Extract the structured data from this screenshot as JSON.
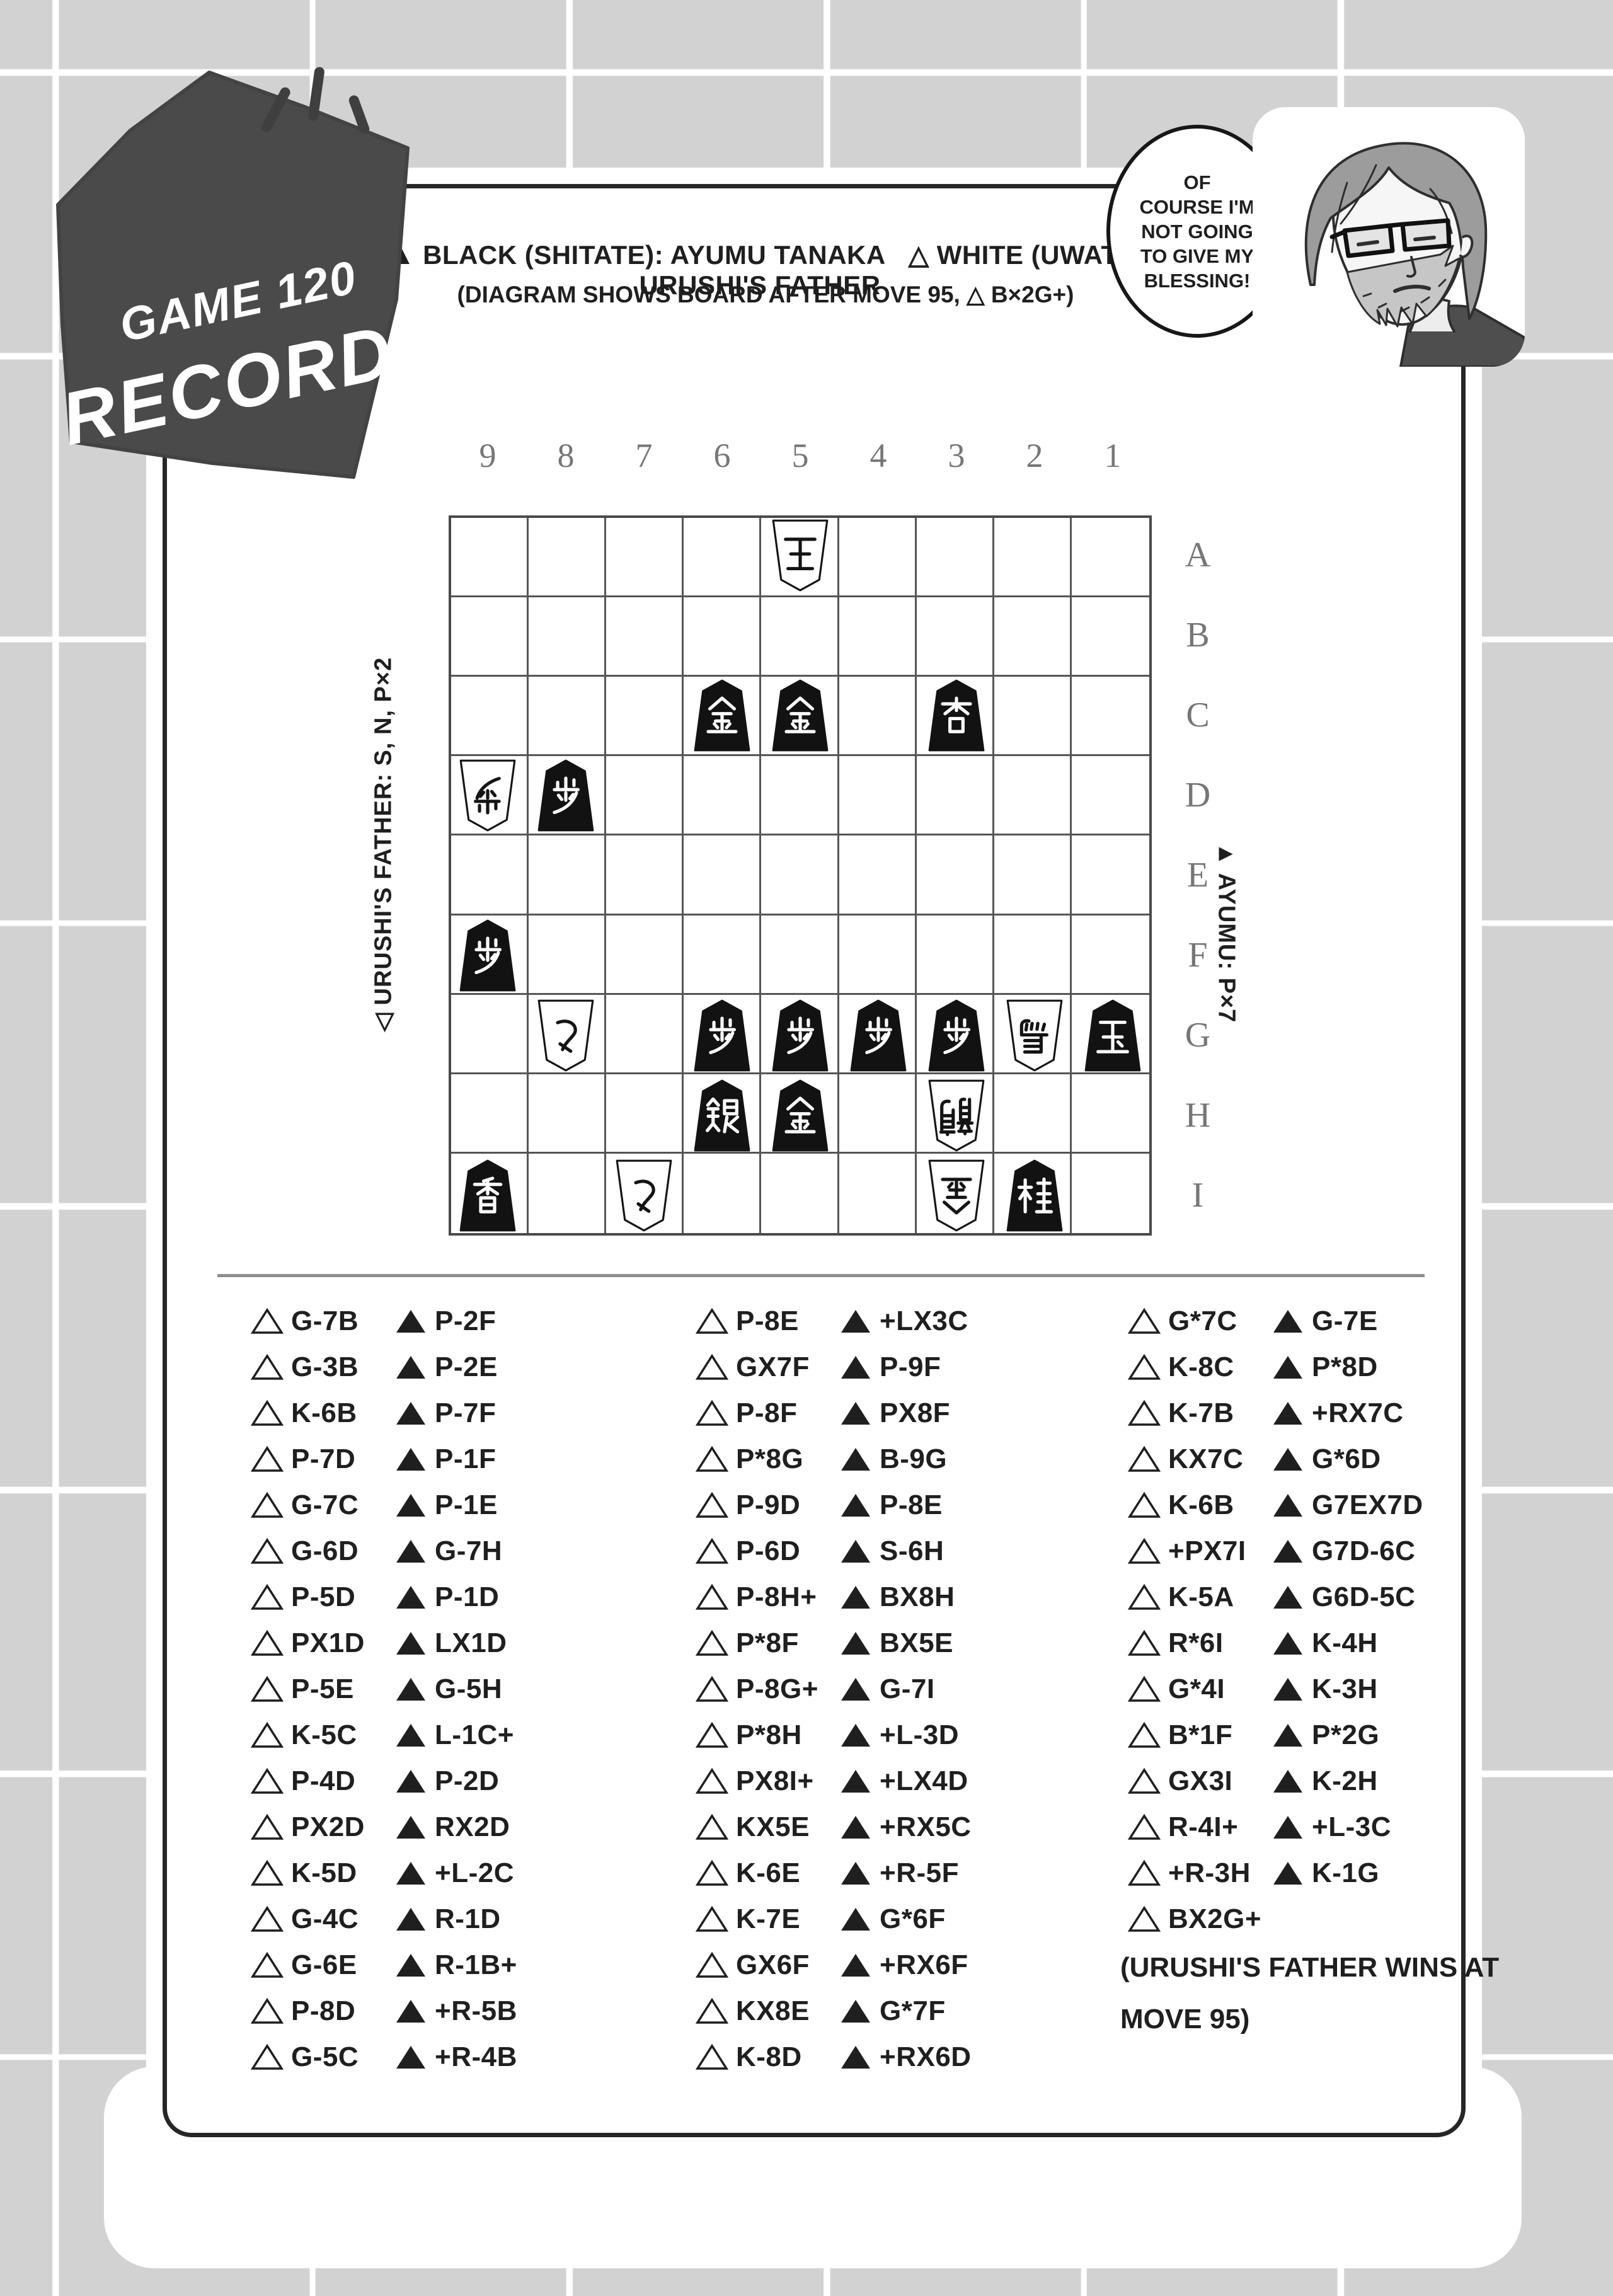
{
  "colors": {
    "page_bg": "#d2d2d2",
    "grid_line": "#ffffff",
    "panel_bg": "#ffffff",
    "panel_border": "#262626",
    "badge_bg": "#4a4a4a",
    "text": "#1f1f1f",
    "board_line": "#4f4f4f",
    "label_gray": "#767676"
  },
  "badge": {
    "line1": "GAME 120",
    "line2": "RECORD"
  },
  "header": {
    "black_side": "▲ BLACK (SHITATE): AYUMU TANAKA",
    "white_side": "△ WHITE (UWATE): URUSHI'S FATHER",
    "note": "(DIAGRAM SHOWS BOARD AFTER MOVE 95, △ B×2G+)"
  },
  "speech_bubble": {
    "lines": [
      "OF",
      "COURSE I'M",
      "NOT GOING",
      "TO GIVE MY",
      "BLESSING!"
    ]
  },
  "board": {
    "columns": [
      "9",
      "8",
      "7",
      "6",
      "5",
      "4",
      "3",
      "2",
      "1"
    ],
    "rows": [
      "A",
      "B",
      "C",
      "D",
      "E",
      "F",
      "G",
      "H",
      "I"
    ],
    "left_label": "◁ URUSHI'S FATHER: S, N, P×2",
    "right_label": "▲ AYUMU: P×7",
    "pieces": [
      {
        "square": "5A",
        "side": "white",
        "piece": "king",
        "kanji": "王"
      },
      {
        "square": "6C",
        "side": "black",
        "piece": "gold",
        "kanji": "金"
      },
      {
        "square": "5C",
        "side": "black",
        "piece": "gold",
        "kanji": "金"
      },
      {
        "square": "3C",
        "side": "black",
        "piece": "promoted-lance",
        "kanji": "杏"
      },
      {
        "square": "9D",
        "side": "white",
        "piece": "pawn",
        "kanji": "歩"
      },
      {
        "square": "8D",
        "side": "black",
        "piece": "pawn",
        "kanji": "歩"
      },
      {
        "square": "9F",
        "side": "black",
        "piece": "pawn",
        "kanji": "歩"
      },
      {
        "square": "8G",
        "side": "white",
        "piece": "tokin",
        "kanji": "と"
      },
      {
        "square": "6G",
        "side": "black",
        "piece": "pawn",
        "kanji": "歩"
      },
      {
        "square": "5G",
        "side": "black",
        "piece": "pawn",
        "kanji": "歩"
      },
      {
        "square": "4G",
        "side": "black",
        "piece": "pawn",
        "kanji": "歩"
      },
      {
        "square": "3G",
        "side": "black",
        "piece": "pawn",
        "kanji": "歩"
      },
      {
        "square": "2G",
        "side": "white",
        "piece": "horse",
        "kanji": "馬"
      },
      {
        "square": "1G",
        "side": "black",
        "piece": "king",
        "kanji": "玉"
      },
      {
        "square": "6H",
        "side": "black",
        "piece": "silver",
        "kanji": "銀"
      },
      {
        "square": "5H",
        "side": "black",
        "piece": "gold",
        "kanji": "金"
      },
      {
        "square": "3H",
        "side": "white",
        "piece": "dragon",
        "kanji": "龍"
      },
      {
        "square": "9I",
        "side": "black",
        "piece": "lance",
        "kanji": "香"
      },
      {
        "square": "7I",
        "side": "white",
        "piece": "tokin",
        "kanji": "と"
      },
      {
        "square": "3I",
        "side": "white",
        "piece": "gold",
        "kanji": "金"
      },
      {
        "square": "2I",
        "side": "black",
        "piece": "knight",
        "kanji": "桂"
      }
    ]
  },
  "moves": {
    "white_symbol": "△",
    "black_symbol": "▲",
    "groups": [
      [
        {
          "w": "G-7B",
          "b": "P-2F"
        },
        {
          "w": "G-3B",
          "b": "P-2E"
        },
        {
          "w": "K-6B",
          "b": "P-7F"
        },
        {
          "w": "P-7D",
          "b": "P-1F"
        },
        {
          "w": "G-7C",
          "b": "P-1E"
        },
        {
          "w": "G-6D",
          "b": "G-7H"
        },
        {
          "w": "P-5D",
          "b": "P-1D"
        },
        {
          "w": "PX1D",
          "b": "LX1D"
        },
        {
          "w": "P-5E",
          "b": "G-5H"
        },
        {
          "w": "K-5C",
          "b": "L-1C+"
        },
        {
          "w": "P-4D",
          "b": "P-2D"
        },
        {
          "w": "PX2D",
          "b": "RX2D"
        },
        {
          "w": "K-5D",
          "b": "+L-2C"
        },
        {
          "w": "G-4C",
          "b": "R-1D"
        },
        {
          "w": "G-6E",
          "b": "R-1B+"
        },
        {
          "w": "P-8D",
          "b": "+R-5B"
        },
        {
          "w": "G-5C",
          "b": "+R-4B"
        }
      ],
      [
        {
          "w": "P-8E",
          "b": "+LX3C"
        },
        {
          "w": "GX7F",
          "b": "P-9F"
        },
        {
          "w": "P-8F",
          "b": "PX8F"
        },
        {
          "w": "P*8G",
          "b": "B-9G"
        },
        {
          "w": "P-9D",
          "b": "P-8E"
        },
        {
          "w": "P-6D",
          "b": "S-6H"
        },
        {
          "w": "P-8H+",
          "b": "BX8H"
        },
        {
          "w": "P*8F",
          "b": "BX5E"
        },
        {
          "w": "P-8G+",
          "b": "G-7I"
        },
        {
          "w": "P*8H",
          "b": "+L-3D"
        },
        {
          "w": "PX8I+",
          "b": "+LX4D"
        },
        {
          "w": "KX5E",
          "b": "+RX5C"
        },
        {
          "w": "K-6E",
          "b": "+R-5F"
        },
        {
          "w": "K-7E",
          "b": "G*6F"
        },
        {
          "w": "GX6F",
          "b": "+RX6F"
        },
        {
          "w": "KX8E",
          "b": "G*7F"
        },
        {
          "w": "K-8D",
          "b": "+RX6D"
        }
      ],
      [
        {
          "w": "G*7C",
          "b": "G-7E"
        },
        {
          "w": "K-8C",
          "b": "P*8D"
        },
        {
          "w": "K-7B",
          "b": "+RX7C"
        },
        {
          "w": "KX7C",
          "b": "G*6D"
        },
        {
          "w": "K-6B",
          "b": "G7EX7D"
        },
        {
          "w": "+PX7I",
          "b": "G7D-6C"
        },
        {
          "w": "K-5A",
          "b": "G6D-5C"
        },
        {
          "w": "R*6I",
          "b": "K-4H"
        },
        {
          "w": "G*4I",
          "b": "K-3H"
        },
        {
          "w": "B*1F",
          "b": "P*2G"
        },
        {
          "w": "GX3I",
          "b": "K-2H"
        },
        {
          "w": "R-4I+",
          "b": "+L-3C"
        },
        {
          "w": "+R-3H",
          "b": "K-1G"
        },
        {
          "w": "BX2G+",
          "b": null
        }
      ]
    ],
    "result_note": [
      "(URUSHI'S FATHER WINS AT",
      "MOVE 95)"
    ]
  }
}
